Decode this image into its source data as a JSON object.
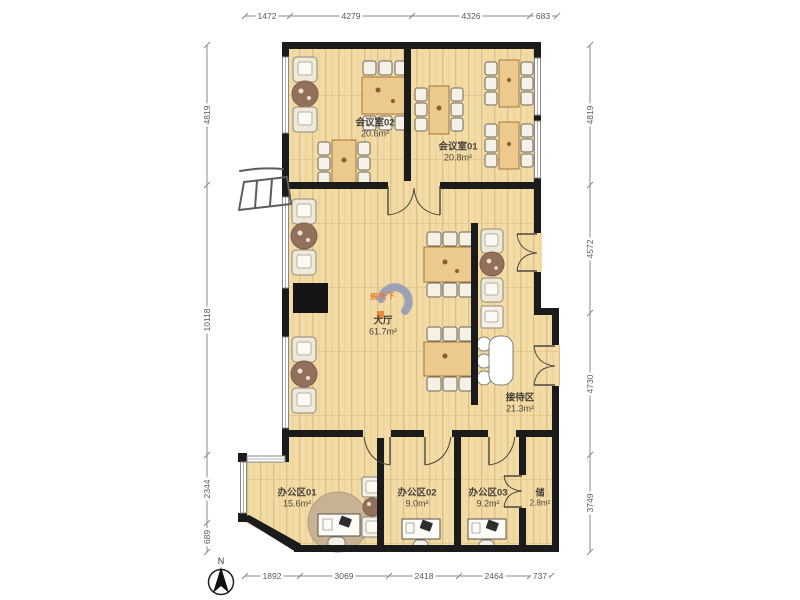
{
  "compass": {
    "north": "N",
    "west": "西"
  },
  "watermark": {
    "text": "房天下"
  },
  "dimensions": {
    "top": [
      "1472",
      "4279",
      "4326",
      "683"
    ],
    "bottom": [
      "1892",
      "3069",
      "2418",
      "2464",
      "737"
    ],
    "left": [
      "4819",
      "10118",
      "2344",
      "689"
    ],
    "right": [
      "4819",
      "4572",
      "4730",
      "3749"
    ]
  },
  "rooms": [
    {
      "name": "会议室02",
      "area": "20.6m²"
    },
    {
      "name": "会议室01",
      "area": "20.8m²"
    },
    {
      "name": "大厅",
      "area": "61.7m²"
    },
    {
      "name": "接待区",
      "area": "21.3m²"
    },
    {
      "name": "办公区01",
      "area": "15.6m²"
    },
    {
      "name": "办公区02",
      "area": "9.0m²"
    },
    {
      "name": "办公区03",
      "area": "9.2m²"
    },
    {
      "name": "储",
      "area": "2.8m²"
    }
  ],
  "colors": {
    "wall": "#1b1b1b",
    "floor": "#f2dba4",
    "floor_stripe": "#dcc08a",
    "table": "#ecc98c",
    "table_border": "#a8743c",
    "round_table": "#93705a",
    "rug": "#c7b294",
    "chair_fill": "#f6f1e6",
    "dim_text": "#595959",
    "label_text": "#3e3a33",
    "watermark_blue": "#8b95bb",
    "watermark_orange": "#e4762d"
  }
}
